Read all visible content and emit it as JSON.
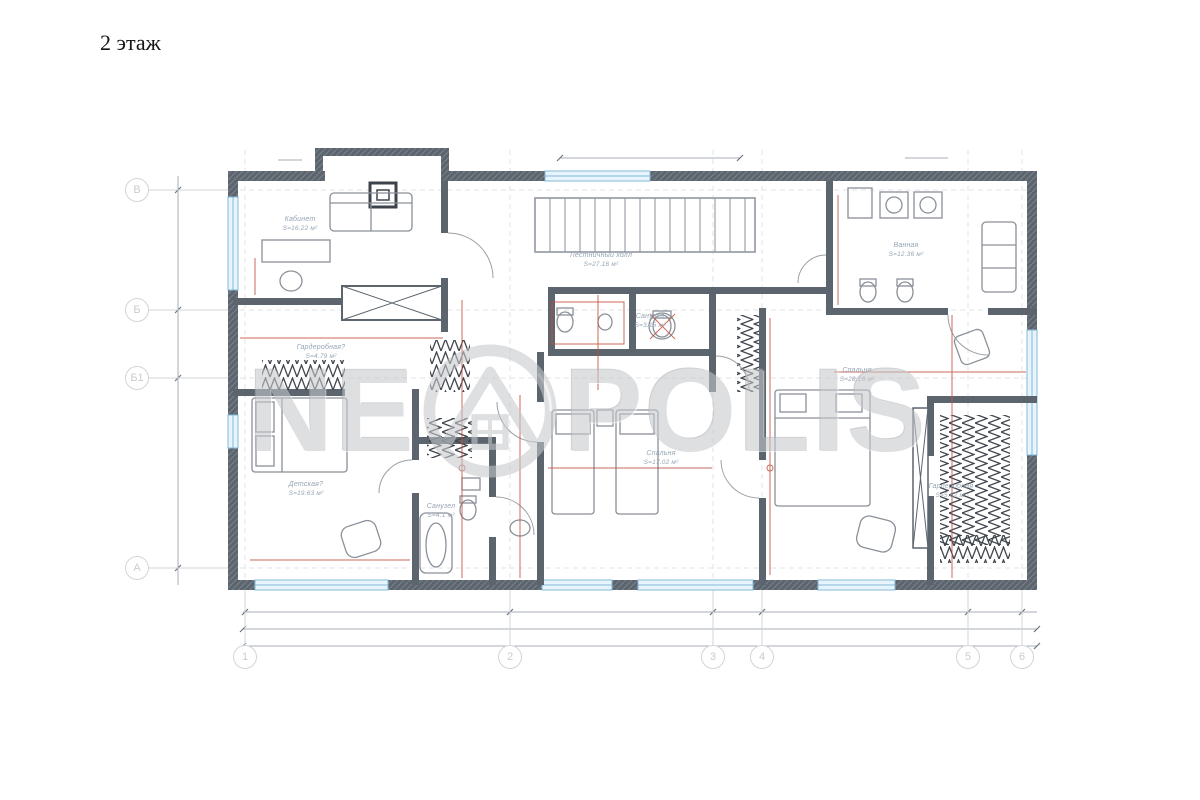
{
  "page": {
    "title": "2 этаж"
  },
  "watermark": {
    "text_left": "NE",
    "text_right": "POLIS",
    "logo_icon": "circle-house-swirl"
  },
  "colors": {
    "wall": "#5c646e",
    "window_fill": "#e8f4fb",
    "window_frame": "#85b9da",
    "accent_red": "#c0503f",
    "room_label": "#96a5b4",
    "grid": "#d8dadd",
    "watermark": "#c6c9cd"
  },
  "axes": {
    "left": [
      "В",
      "Б",
      "Б1",
      "А"
    ],
    "bottom": [
      "1",
      "2",
      "3",
      "4",
      "5",
      "6"
    ]
  },
  "rooms": [
    {
      "name": "Кабинет",
      "area": "S=16.22 м²"
    },
    {
      "name": "Лестничный холл",
      "area": "S=27.16 м²"
    },
    {
      "name": "Ванная",
      "area": "S=12.36 м²"
    },
    {
      "name": "Гардеробная?",
      "area": "S=4.79 м²"
    },
    {
      "name": "Санузел",
      "area": "S=3.15 м²"
    },
    {
      "name": "Спальня",
      "area": "S=28.16 м²"
    },
    {
      "name": "Детская?",
      "area": "S=19.63 м²"
    },
    {
      "name": "Санузел",
      "area": "S=4.1 м²"
    },
    {
      "name": "Спальня",
      "area": "S=17.02 м²"
    },
    {
      "name": "Гардеробная",
      "area": "S=5.62 м²"
    }
  ]
}
